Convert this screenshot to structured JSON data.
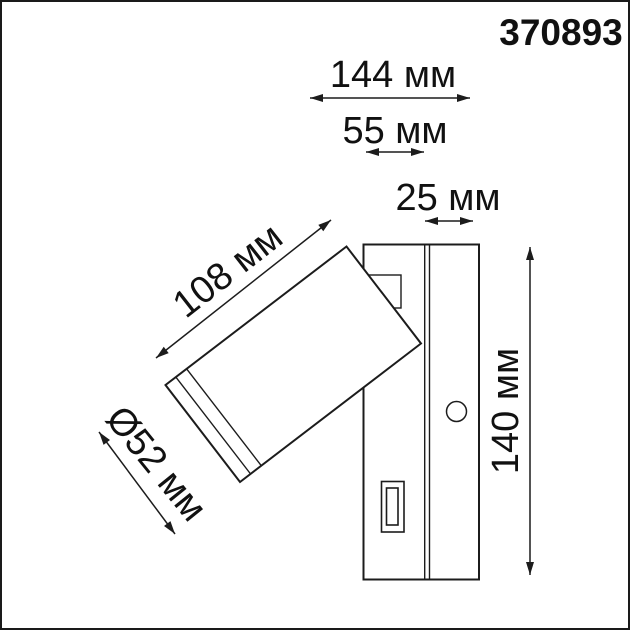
{
  "product_code": "370893",
  "colors": {
    "line": "#1c1c1c",
    "text": "#111111",
    "background": "#ffffff"
  },
  "labels": {
    "dim_total_width": "144 мм",
    "dim_base_width": "55 мм",
    "dim_depth": "25 мм",
    "dim_head_length": "108 мм",
    "dim_head_diameter": "Ø52 мм",
    "dim_height": "140 мм"
  }
}
